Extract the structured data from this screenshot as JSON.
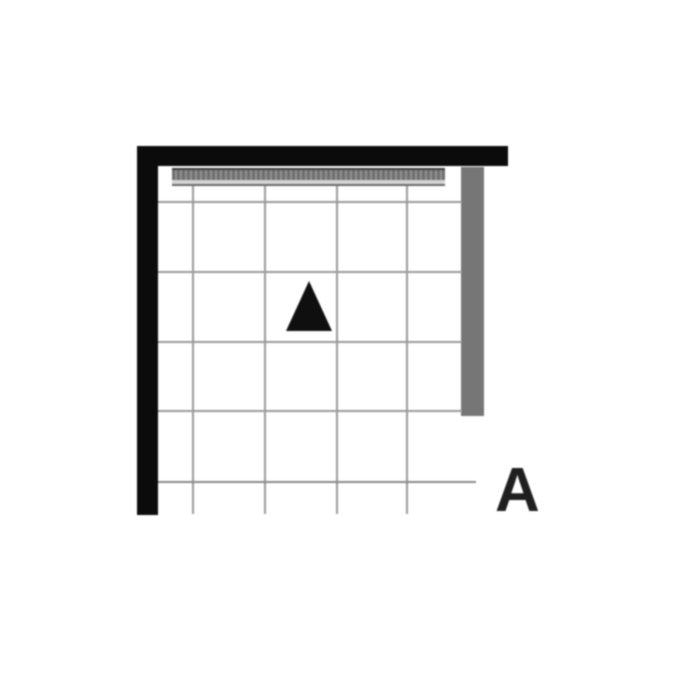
{
  "figure": {
    "type": "floor-plan-grid-diagram",
    "label": "A",
    "marker": "triangle-up"
  },
  "colors": {
    "background": "#ffffff",
    "wall": "#0b0b0b",
    "gray-bar": "#767676",
    "grid-line": "#999999",
    "grid-line-bottom": "#8a8a8a",
    "hatch-dark": "#3d3d3d",
    "hatch-mid": "#6f6f6f",
    "hatch-stripe": "#919191",
    "hatch-light": "#d4d4d4",
    "hatch-bottom": "#6a6a6a",
    "triangle": "#0f0f0f",
    "label": "#1f1f1f"
  }
}
